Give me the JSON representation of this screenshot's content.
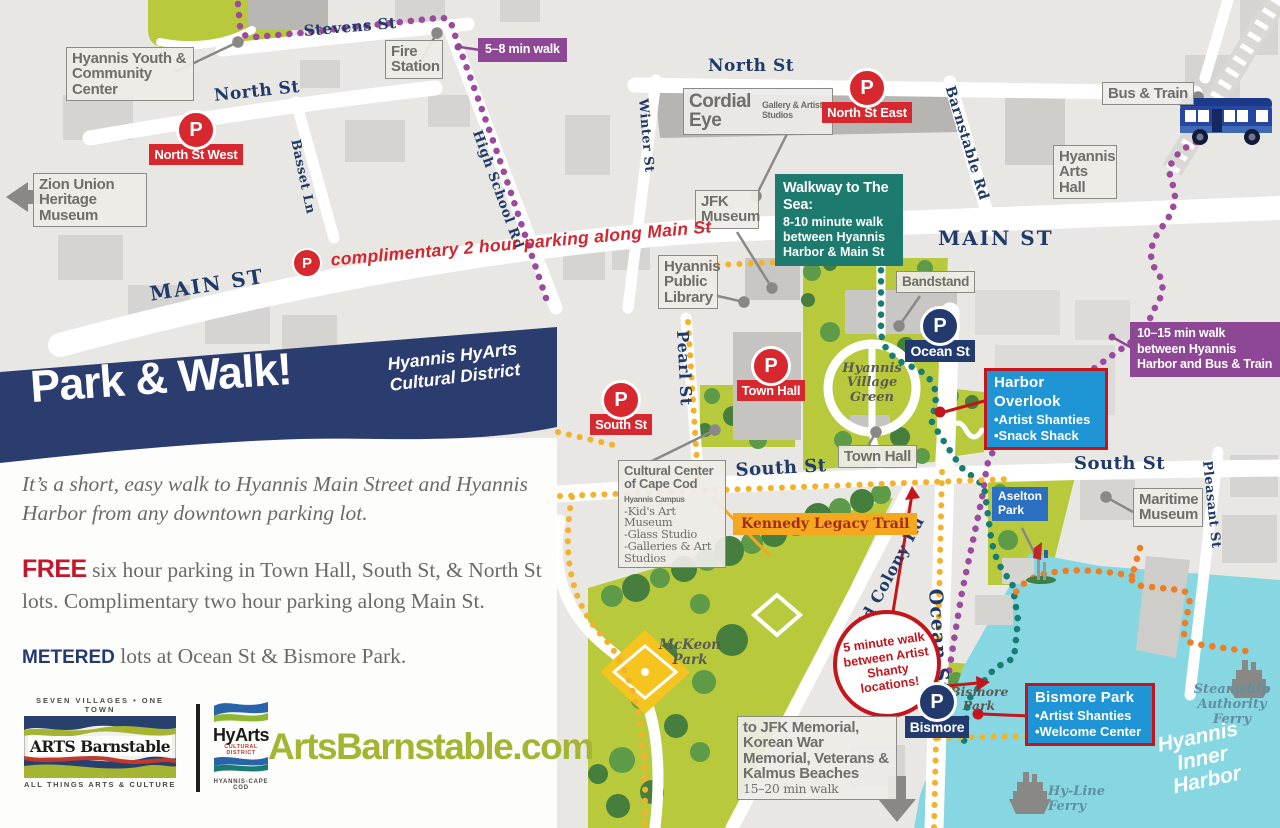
{
  "colors": {
    "navy": "#223a6e",
    "red": "#d7282f",
    "purple": "#8d4795",
    "teal": "#1c7a6f",
    "callout_blue": "#2095d5",
    "callout_border": "#c3161c",
    "yellow": "#f3b229",
    "orange": "#ee7d23",
    "park_green": "#b9c93c",
    "water": "#86d7e2",
    "olive": "#a5b431"
  },
  "glyphs": {
    "p": "P"
  },
  "panel": {
    "title": "Park & Walk!",
    "subtitle1": "Hyannis HyArts",
    "subtitle2": "Cultural District",
    "intro": "It’s a short, easy walk to Hyannis Main Street and Hyannis Harbor from any downtown parking lot.",
    "free_label": "FREE",
    "free_text": " six hour parking in Town Hall, South St, & North St lots. Complimentary two hour parking along Main St.",
    "metered_label": "METERED",
    "metered_text": " lots at Ocean St & Bismore Park.",
    "website": "ArtsBarnstable.com",
    "arts_logo": {
      "top": "SEVEN VILLAGES • ONE TOWN",
      "name": "ARTS Barnstable",
      "bottom": "ALL THINGS ARTS & CULTURE"
    },
    "hyarts_logo": {
      "name": "HyArts",
      "district": "CULTURAL DISTRICT",
      "sub": "HYANNIS-CAPE COD"
    }
  },
  "map": {
    "streets": {
      "stevens": "Stevens St",
      "north_west": "North St",
      "north_top": "North St",
      "main_left": "MAIN ST",
      "main_right": "MAIN ST",
      "basset": "Basset Ln",
      "high_school": "High School Rd",
      "winter": "Winter St",
      "barnstable": "Barnstable Rd",
      "pearl": "Pearl St",
      "south_mid": "South St",
      "south_right": "South St",
      "pleasant": "Pleasant St",
      "old_colony": "Old Colony Rd",
      "ocean": "Ocean St"
    },
    "places": {
      "hyannis_youth": "Hyannis Youth & Community Center",
      "fire_station": "Fire Station",
      "zion": "Zion Union Heritage Museum",
      "cordial_eye": "Cordial Eye",
      "cordial_eye_sub": "Gallery & Artist Studios",
      "jfk_museum": "JFK Museum",
      "library": "Hyannis Public Library",
      "bandstand": "Bandstand",
      "town_hall": "Town Hall",
      "arts_hall": "Hyannis Arts Hall",
      "bus_train": "Bus & Train",
      "maritime": "Maritime Museum",
      "village_green": "Hyannis Village Green",
      "mckeon": "McKeon Park",
      "bismore_green": "Bismore Park",
      "aselton": "Aselton Park",
      "steamship": "Steamship Authority Ferry",
      "hyline": "Hy-Line Ferry",
      "inner_harbor": "Hyannis Inner Harbor"
    },
    "parking": {
      "north_st_west": "North St West",
      "north_st_east": "North St East",
      "town_hall": "Town Hall",
      "south_st": "South St",
      "ocean_st": "Ocean St",
      "bismore": "Bismore",
      "main_st_note": "complimentary 2 hour parking along Main St"
    },
    "callouts": {
      "walk58": "5–8 min walk",
      "walk1015": "10–15 min walk between Hyannis Harbor and Bus & Train",
      "walkway_title": "Walkway to The Sea:",
      "walkway_body": "8-10 minute walk between Hyannis Harbor & Main St",
      "harbor_title": "Harbor Overlook",
      "harbor_b1": "•Artist Shanties",
      "harbor_b2": "•Snack Shack",
      "bismore_title": "Bismore Park",
      "bismore_b1": "•Artist Shanties",
      "bismore_b2": "•Welcome Center",
      "kennedy": "Kennedy Legacy Trail",
      "five_min": "5 minute walk between Artist Shanty locations!",
      "cc_title": "Cultural Center of Cape Cod",
      "cc_campus": "Hyannis Campus",
      "cc_items": [
        "-Kid's Art Museum",
        "-Glass Studio",
        "-Galleries & Art Studios"
      ],
      "jfk_memorial": "to JFK Memorial, Korean War Memorial, Veterans & Kalmus Beaches",
      "jfk_memorial_sub": "15–20 min walk"
    }
  }
}
